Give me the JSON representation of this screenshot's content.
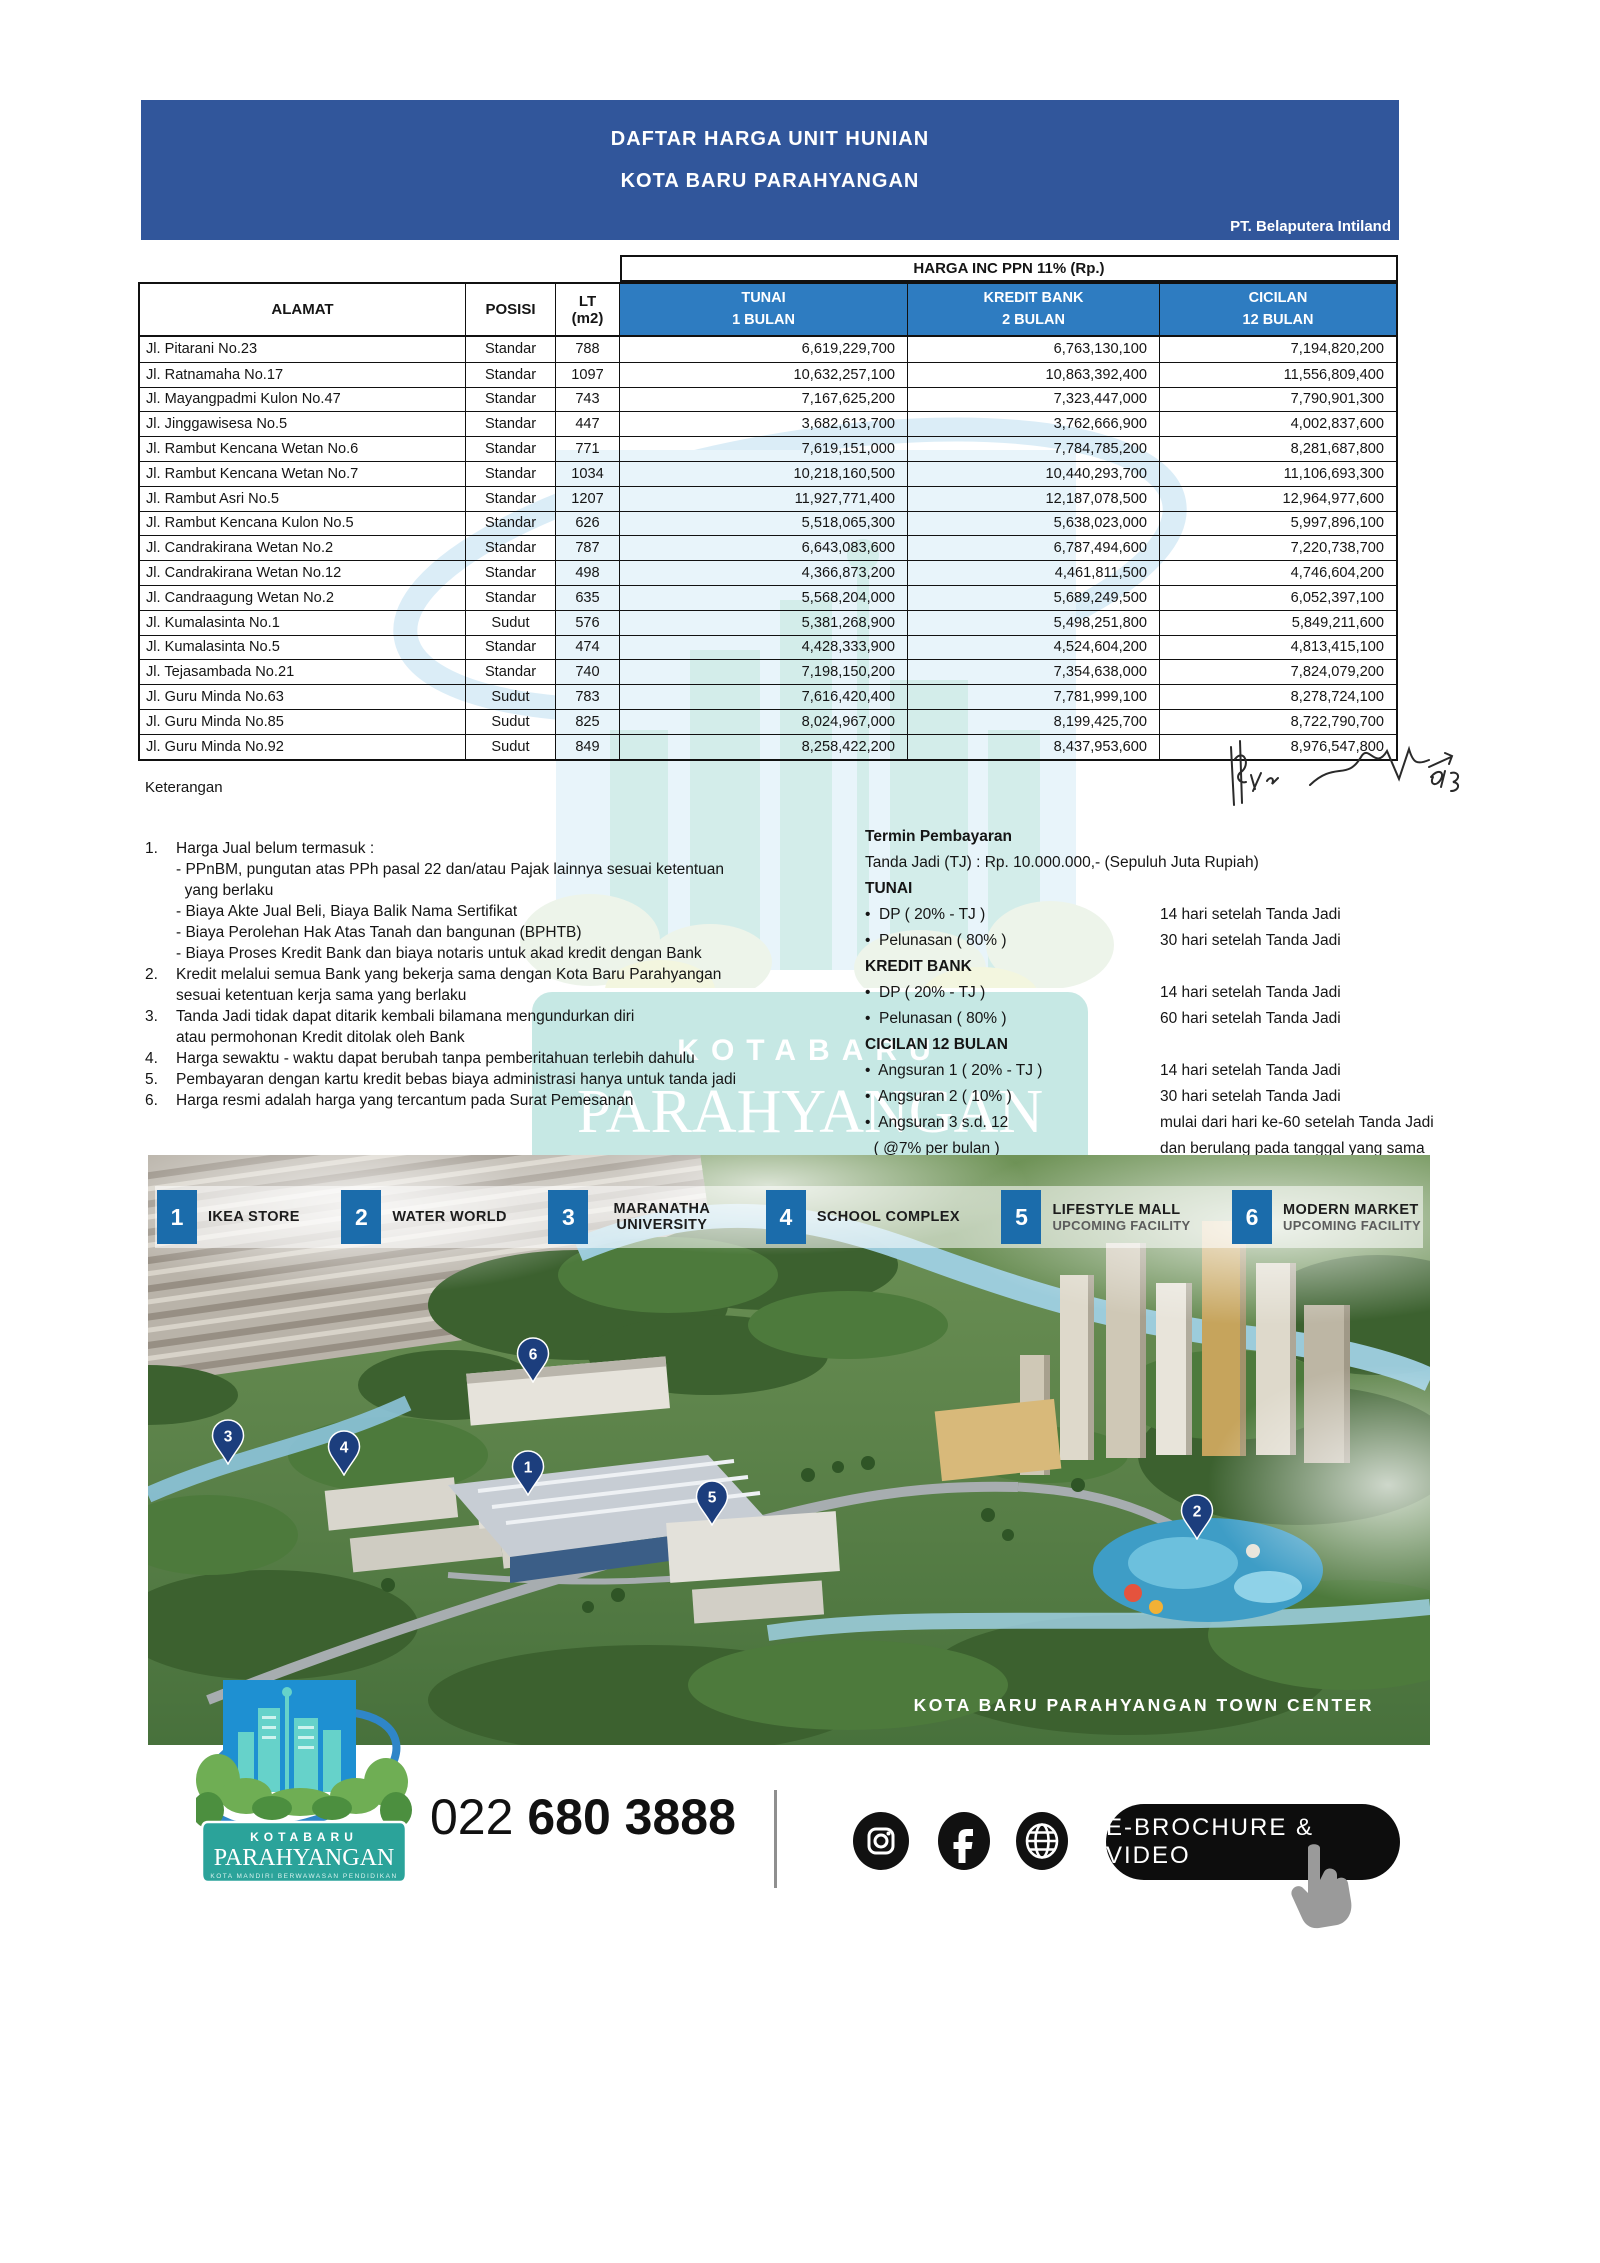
{
  "colors": {
    "banner_blue": "#31569B",
    "header_blue": "#2E7CC1",
    "tile_blue": "#1B6CAB",
    "pin_navy": "#1C3E7D",
    "logo_blue": "#1E90D2",
    "logo_teal": "#2BA39A"
  },
  "banner": {
    "title1": "DAFTAR HARGA UNIT HUNIAN",
    "title2": "KOTA BARU PARAHYANGAN",
    "company": "PT. Belaputera Intiland"
  },
  "table": {
    "harga_header": "HARGA INC PPN 11% (Rp.)",
    "col_alamat": "ALAMAT",
    "col_posisi": "POSISI",
    "col_lt1": "LT",
    "col_lt2": "(m2)",
    "price_cols": [
      {
        "l1": "TUNAI",
        "l2": "1 BULAN"
      },
      {
        "l1": "KREDIT BANK",
        "l2": "2 BULAN"
      },
      {
        "l1": "CICILAN",
        "l2": "12 BULAN"
      }
    ],
    "rows": [
      {
        "alamat": "Jl. Pitarani No.23",
        "posisi": "Standar",
        "lt": "788",
        "tunai": "6,619,229,700",
        "kredit": "6,763,130,100",
        "cicilan": "7,194,820,200"
      },
      {
        "alamat": "Jl. Ratnamaha No.17",
        "posisi": "Standar",
        "lt": "1097",
        "tunai": "10,632,257,100",
        "kredit": "10,863,392,400",
        "cicilan": "11,556,809,400"
      },
      {
        "alamat": "Jl. Mayangpadmi Kulon No.47",
        "posisi": "Standar",
        "lt": "743",
        "tunai": "7,167,625,200",
        "kredit": "7,323,447,000",
        "cicilan": "7,790,901,300"
      },
      {
        "alamat": "Jl. Jinggawisesa No.5",
        "posisi": "Standar",
        "lt": "447",
        "tunai": "3,682,613,700",
        "kredit": "3,762,666,900",
        "cicilan": "4,002,837,600"
      },
      {
        "alamat": "Jl. Rambut Kencana Wetan No.6",
        "posisi": "Standar",
        "lt": "771",
        "tunai": "7,619,151,000",
        "kredit": "7,784,785,200",
        "cicilan": "8,281,687,800"
      },
      {
        "alamat": "Jl. Rambut Kencana Wetan No.7",
        "posisi": "Standar",
        "lt": "1034",
        "tunai": "10,218,160,500",
        "kredit": "10,440,293,700",
        "cicilan": "11,106,693,300"
      },
      {
        "alamat": "Jl. Rambut Asri No.5",
        "posisi": "Standar",
        "lt": "1207",
        "tunai": "11,927,771,400",
        "kredit": "12,187,078,500",
        "cicilan": "12,964,977,600"
      },
      {
        "alamat": "Jl. Rambut Kencana Kulon No.5",
        "posisi": "Standar",
        "lt": "626",
        "tunai": "5,518,065,300",
        "kredit": "5,638,023,000",
        "cicilan": "5,997,896,100"
      },
      {
        "alamat": "Jl. Candrakirana Wetan No.2",
        "posisi": "Standar",
        "lt": "787",
        "tunai": "6,643,083,600",
        "kredit": "6,787,494,600",
        "cicilan": "7,220,738,700"
      },
      {
        "alamat": "Jl. Candrakirana Wetan No.12",
        "posisi": "Standar",
        "lt": "498",
        "tunai": "4,366,873,200",
        "kredit": "4,461,811,500",
        "cicilan": "4,746,604,200"
      },
      {
        "alamat": "Jl. Candraagung Wetan No.2",
        "posisi": "Standar",
        "lt": "635",
        "tunai": "5,568,204,000",
        "kredit": "5,689,249,500",
        "cicilan": "6,052,397,100"
      },
      {
        "alamat": "Jl. Kumalasinta No.1",
        "posisi": "Sudut",
        "lt": "576",
        "tunai": "5,381,268,900",
        "kredit": "5,498,251,800",
        "cicilan": "5,849,211,600"
      },
      {
        "alamat": "Jl. Kumalasinta No.5",
        "posisi": "Standar",
        "lt": "474",
        "tunai": "4,428,333,900",
        "kredit": "4,524,604,200",
        "cicilan": "4,813,415,100"
      },
      {
        "alamat": "Jl. Tejasambada No.21",
        "posisi": "Standar",
        "lt": "740",
        "tunai": "7,198,150,200",
        "kredit": "7,354,638,000",
        "cicilan": "7,824,079,200"
      },
      {
        "alamat": "Jl. Guru Minda No.63",
        "posisi": "Sudut",
        "lt": "783",
        "tunai": "7,616,420,400",
        "kredit": "7,781,999,100",
        "cicilan": "8,278,724,100"
      },
      {
        "alamat": "Jl. Guru Minda No.85",
        "posisi": "Sudut",
        "lt": "825",
        "tunai": "8,024,967,000",
        "kredit": "8,199,425,700",
        "cicilan": "8,722,790,700"
      },
      {
        "alamat": "Jl. Guru Minda No.92",
        "posisi": "Sudut",
        "lt": "849",
        "tunai": "8,258,422,200",
        "kredit": "8,437,953,600",
        "cicilan": "8,976,547,800"
      }
    ]
  },
  "keterangan": {
    "title": "Keterangan",
    "notes": [
      {
        "num": "1.",
        "lines": [
          "Harga Jual belum termasuk :",
          "- PPnBM, pungutan atas PPh pasal 22 dan/atau Pajak lainnya sesuai ketentuan",
          "  yang berlaku",
          "- Biaya Akte Jual Beli, Biaya Balik Nama Sertifikat",
          "- Biaya Perolehan Hak Atas Tanah dan bangunan (BPHTB)",
          "- Biaya Proses Kredit Bank dan biaya notaris untuk akad kredit dengan Bank"
        ]
      },
      {
        "num": "2.",
        "lines": [
          "Kredit melalui semua Bank yang bekerja sama dengan Kota Baru Parahyangan",
          "sesuai ketentuan kerja sama yang berlaku"
        ]
      },
      {
        "num": "3.",
        "lines": [
          "Tanda Jadi tidak dapat ditarik kembali bilamana mengundurkan diri",
          "atau permohonan Kredit ditolak oleh Bank"
        ]
      },
      {
        "num": "4.",
        "lines": [
          "Harga sewaktu - waktu dapat berubah tanpa pemberitahuan terlebih dahulu"
        ]
      },
      {
        "num": "5.",
        "lines": [
          "Pembayaran dengan kartu kredit bebas biaya administrasi hanya untuk tanda jadi"
        ]
      },
      {
        "num": "6.",
        "lines": [
          "Harga resmi adalah harga yang tercantum pada Surat Pemesanan"
        ]
      }
    ]
  },
  "termin": {
    "title": "Termin Pembayaran",
    "tanda_jadi": "Tanda Jadi (TJ) : Rp. 10.000.000,- (Sepuluh Juta Rupiah)",
    "groups": [
      {
        "heading": "TUNAI",
        "items": [
          {
            "label_lines": [
              "•  DP ( 20% - TJ )"
            ],
            "timing_lines": [
              "14 hari setelah Tanda Jadi"
            ]
          },
          {
            "label_lines": [
              "•  Pelunasan ( 80% )"
            ],
            "timing_lines": [
              "30 hari setelah Tanda Jadi"
            ]
          }
        ]
      },
      {
        "heading": "KREDIT BANK",
        "items": [
          {
            "label_lines": [
              "•  DP ( 20% - TJ )"
            ],
            "timing_lines": [
              "14 hari setelah Tanda Jadi"
            ]
          },
          {
            "label_lines": [
              "•  Pelunasan ( 80% )"
            ],
            "timing_lines": [
              "60 hari setelah Tanda Jadi"
            ]
          }
        ]
      },
      {
        "heading": "CICILAN 12 BULAN",
        "items": [
          {
            "label_lines": [
              "•  Angsuran 1 ( 20% - TJ )"
            ],
            "timing_lines": [
              "14 hari setelah Tanda Jadi"
            ]
          },
          {
            "label_lines": [
              "•  Angsuran 2 ( 10% )"
            ],
            "timing_lines": [
              "30 hari setelah Tanda Jadi"
            ]
          },
          {
            "label_lines": [
              "•  Angsuran 3 s.d. 12",
              "  ( @7% per bulan )"
            ],
            "timing_lines": [
              "mulai dari hari ke-60 setelah Tanda Jadi",
              "dan berulang pada tanggal yang sama",
              "di setiap bulan berikutnya"
            ]
          }
        ]
      }
    ]
  },
  "map": {
    "caption": "KOTA BARU PARAHYANGAN TOWN CENTER",
    "facilities": [
      {
        "num": "1",
        "name": "IKEA STORE",
        "sub": "",
        "wrap": false
      },
      {
        "num": "2",
        "name": "WATER WORLD",
        "sub": "",
        "wrap": false
      },
      {
        "num": "3",
        "name": "MARANATHA UNIVERSITY",
        "sub": "",
        "wrap": true
      },
      {
        "num": "4",
        "name": "SCHOOL COMPLEX",
        "sub": "",
        "wrap": false
      },
      {
        "num": "5",
        "name": "LIFESTYLE MALL",
        "sub": "UPCOMING FACILITY",
        "wrap": false
      },
      {
        "num": "6",
        "name": "MODERN MARKET",
        "sub": "UPCOMING FACILITY",
        "wrap": false
      }
    ],
    "pins": [
      {
        "num": "6",
        "x": 385,
        "y": 200
      },
      {
        "num": "3",
        "x": 80,
        "y": 282
      },
      {
        "num": "4",
        "x": 196,
        "y": 293
      },
      {
        "num": "1",
        "x": 380,
        "y": 313
      },
      {
        "num": "5",
        "x": 564,
        "y": 343
      },
      {
        "num": "2",
        "x": 1049,
        "y": 357
      }
    ]
  },
  "footer": {
    "phone_prefix": "022",
    "phone_number": "680 3888",
    "ebrochure_label": "E-BROCHURE & VIDEO",
    "logo_line1": "KOTABARU",
    "logo_line2": "PARAHYANGAN",
    "logo_line3": "KOTA MANDIRI BERWAWASAN PENDIDIKAN",
    "social": [
      "instagram",
      "facebook",
      "website"
    ]
  }
}
